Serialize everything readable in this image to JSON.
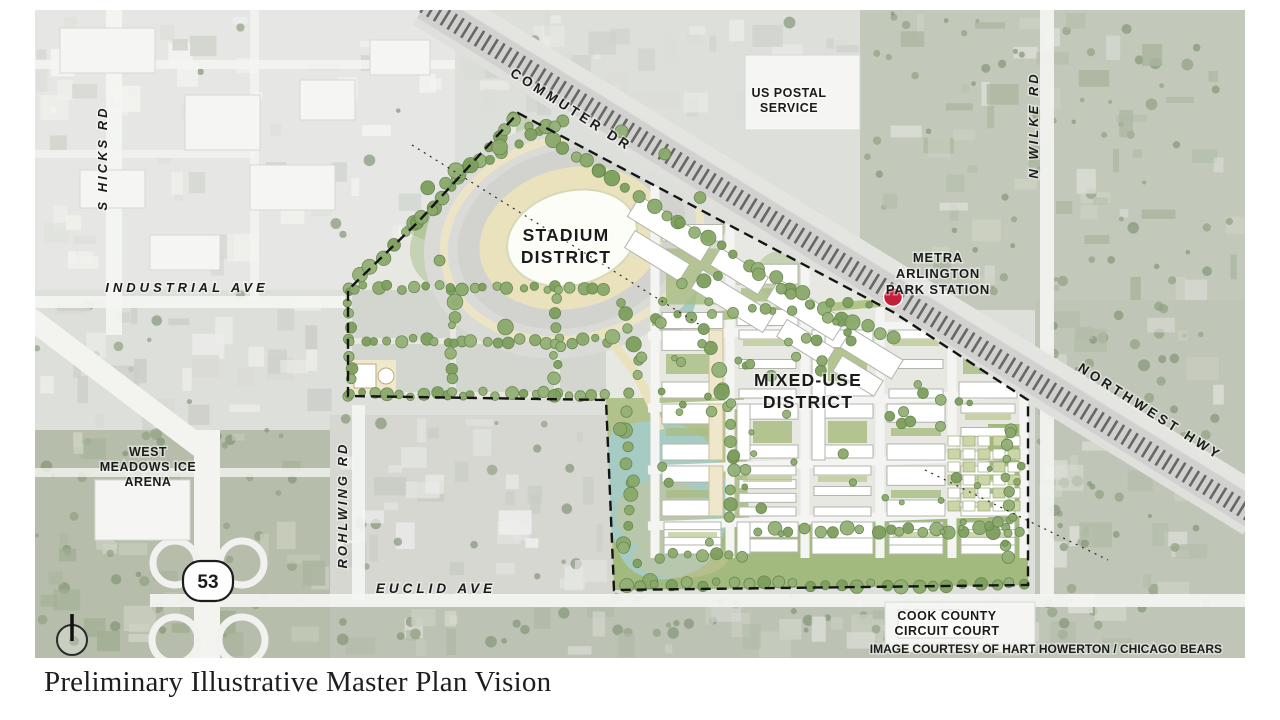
{
  "title": "Preliminary Illustrative Master Plan Vision",
  "credit": "IMAGE COURTESY OF HART HOWERTON / CHICAGO BEARS",
  "districts": {
    "stadium": {
      "lines": [
        "STADIUM",
        "DISTRICT"
      ]
    },
    "mixed_use": {
      "lines": [
        "MIXED-USE",
        "DISTRICT"
      ]
    }
  },
  "roads": {
    "s_hicks": "S HICKS RD",
    "industrial": "INDUSTRIAL AVE",
    "rohlwing": "ROHLWING RD",
    "euclid": "EUCLID AVE",
    "commuter": "COMMUTER DR",
    "n_wilke": "N WILKE RD",
    "northwest_hwy": "NORTHWEST HWY",
    "route_shield": "53"
  },
  "landmarks": {
    "us_postal": {
      "lines": [
        "US POSTAL",
        "SERVICE"
      ]
    },
    "metra_station": {
      "lines": [
        "METRA",
        "ARLINGTON",
        "PARK STATION"
      ]
    },
    "west_meadows": {
      "lines": [
        "WEST",
        "MEADOWS ICE",
        "ARENA"
      ]
    },
    "cook_county": {
      "lines": [
        "COOK COUNTY",
        "CIRCUIT COURT"
      ]
    }
  },
  "colors": {
    "station_dot": "#c2203a",
    "tree_green": "#85a566",
    "pond_teal": "#a5cbc2",
    "track_cream": "#eae1bd",
    "boundary": "#141414"
  }
}
